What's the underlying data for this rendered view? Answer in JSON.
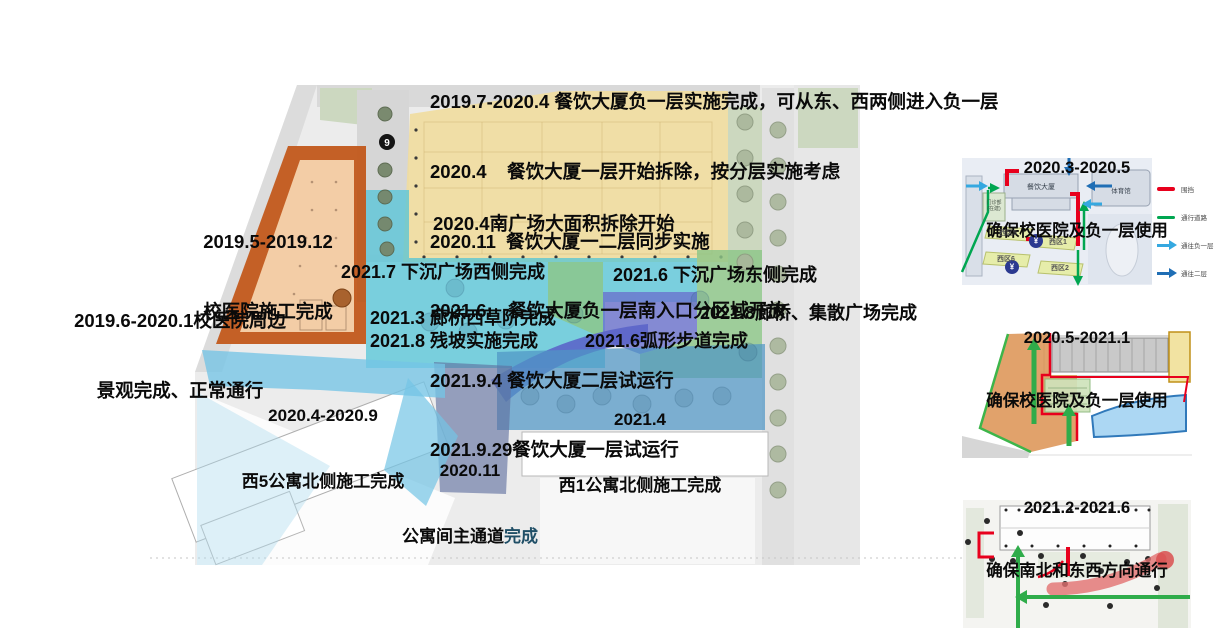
{
  "map": {
    "marker9": "9"
  },
  "main": {
    "dining_lines": [
      "2019.7-2020.4 餐饮大厦负一层实施完成，可从东、西两侧进入负一层",
      "2020.4    餐饮大厦一层开始拆除，按分层实施考虑",
      "2020.11  餐饮大厦一二层同步实施",
      "2021.6:   餐饮大厦负一层南入口分区域开放",
      "2021.9.4 餐饮大厦二层试运行",
      "2021.9.29餐饮大厦一层试运行"
    ],
    "south_plaza": "2020.4南广场大面积拆除开始",
    "hospital": {
      "line1": "2019.5-2019.12",
      "line2": "校医院施工完成"
    },
    "hospital_surround": {
      "line1": "2019.6-2020.1校医院周边",
      "line2": "景观完成、正常通行"
    },
    "sunken_west": "2021.7 下沉广场西侧完成",
    "sunken_east": "2021.6 下沉广场东侧完成",
    "gallery_west": "2021.3 廊桥西草阶完成",
    "slope": "2021.8 残坡实施完成",
    "gallery_plaza": "2021.8廊桥、集散广场完成",
    "arc_path": "2021.6弧形步道完成",
    "west5": {
      "line1": "2020.4-2020.9",
      "line2": "西5公寓北侧施工完成"
    },
    "west1": {
      "line1": "2021.4",
      "line2": "西1公寓北侧施工完成"
    },
    "corridor": {
      "line1": "2020.11",
      "line2_black": "公寓间主通道",
      "line2_blue": "完成"
    }
  },
  "thumbnails": [
    {
      "title1": "2020.3-2020.5",
      "title2": "确保校医院及负一层使用",
      "labels": {
        "dining": "餐饮大厦",
        "gym": "体育馆",
        "clinic1": "门诊部",
        "clinic2": "(在建)",
        "z5": "西区5",
        "z1": "西区1",
        "z6": "西区6",
        "z2": "西区2",
        "yen": "¥"
      },
      "legend": [
        "围挡",
        "通行道路",
        "通往负一层",
        "通往二层"
      ]
    },
    {
      "title1": "2020.5-2021.1",
      "title2": "确保校医院及负一层使用"
    },
    {
      "title1": "2021.2-2021.6",
      "title2": "确保南北和东西方向通行"
    }
  ],
  "colors": {
    "teal": "#4ec4d8",
    "yellow": "#f1dd9e",
    "green": "#8cc688",
    "periwinkle": "#6a72cd",
    "west1_blue": "#4f95c5",
    "west5_blue": "#74c4e6",
    "corridor_slate": "#5e6e9e",
    "hospital_border": "#c2591b",
    "hospital_fill": "#f3cda6",
    "fence_red": "#e8001d",
    "route_green": "#00a651",
    "to_basement_blue": "#35a8e0",
    "to_level2_blue": "#1f6eb5"
  }
}
